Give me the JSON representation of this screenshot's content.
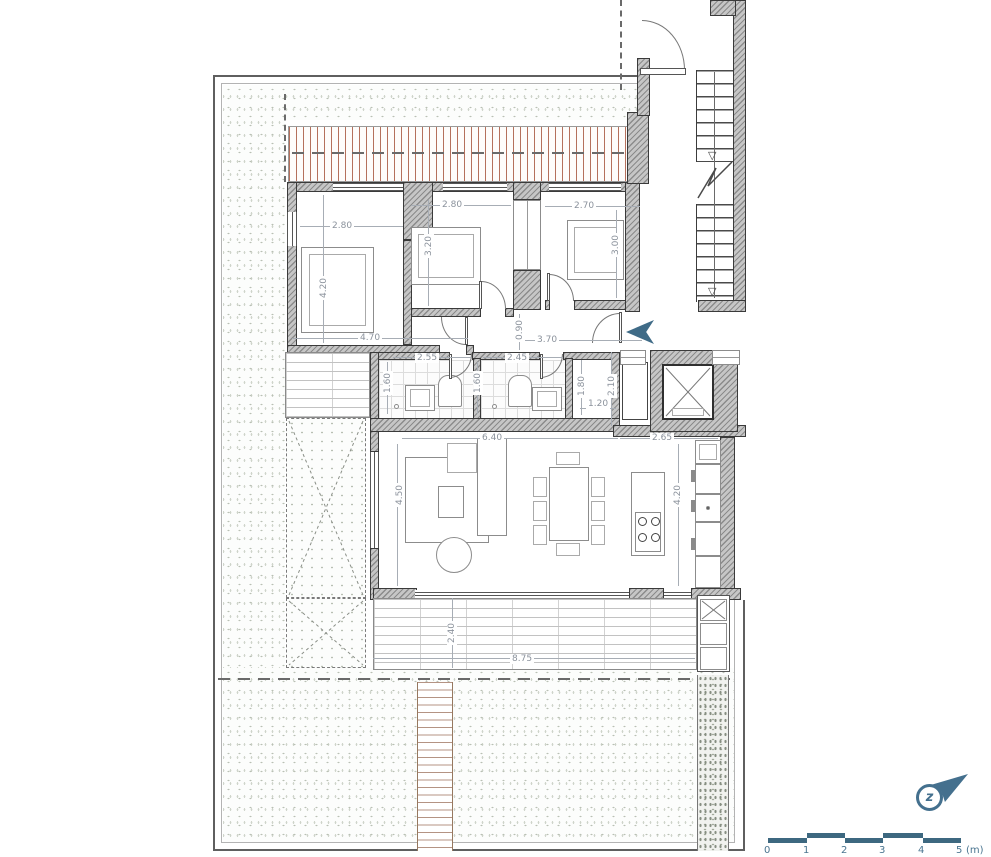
{
  "drawing": {
    "kind": "apartment floor plan",
    "scale_unit": "(m)"
  },
  "dims": [
    {
      "id": "bedroom1-width",
      "value": "2.80"
    },
    {
      "id": "bedroom1-depth",
      "value": "4.20"
    },
    {
      "id": "bedroom1-south-width",
      "value": "4.70"
    },
    {
      "id": "bedroom2-width",
      "value": "2.80"
    },
    {
      "id": "bedroom2-depth",
      "value": "3.20"
    },
    {
      "id": "bedroom3-width",
      "value": "2.70"
    },
    {
      "id": "bedroom3-depth",
      "value": "3.00"
    },
    {
      "id": "hallway-width",
      "value": "0.90"
    },
    {
      "id": "hallway-length",
      "value": "3.70"
    },
    {
      "id": "bathroom1-width",
      "value": "2.55"
    },
    {
      "id": "bathroom1-depth",
      "value": "1.60"
    },
    {
      "id": "bathroom2-width",
      "value": "2.45"
    },
    {
      "id": "bathroom2-depth",
      "value": "1.60"
    },
    {
      "id": "entry-hall-depth",
      "value": "1.80"
    },
    {
      "id": "entry-hall-width",
      "value": "1.20"
    },
    {
      "id": "elevator-lobby-depth",
      "value": "2.10"
    },
    {
      "id": "kitchen-width",
      "value": "2.65"
    },
    {
      "id": "living-room-width",
      "value": "6.40"
    },
    {
      "id": "living-room-depth",
      "value": "4.50"
    },
    {
      "id": "kitchen-depth",
      "value": "4.20"
    },
    {
      "id": "terrace-depth",
      "value": "2.40"
    },
    {
      "id": "terrace-width",
      "value": "8.75"
    }
  ],
  "scale": {
    "labels": [
      "0",
      "1",
      "2",
      "3",
      "4",
      "5"
    ],
    "unit": "(m)"
  },
  "logo": {
    "letter": "z"
  },
  "colors": {
    "accent_blue": "#44708e",
    "wall_gray": "#8b8b8b",
    "pergola_red": "#b5705c",
    "dim_text": "#8b929c"
  }
}
